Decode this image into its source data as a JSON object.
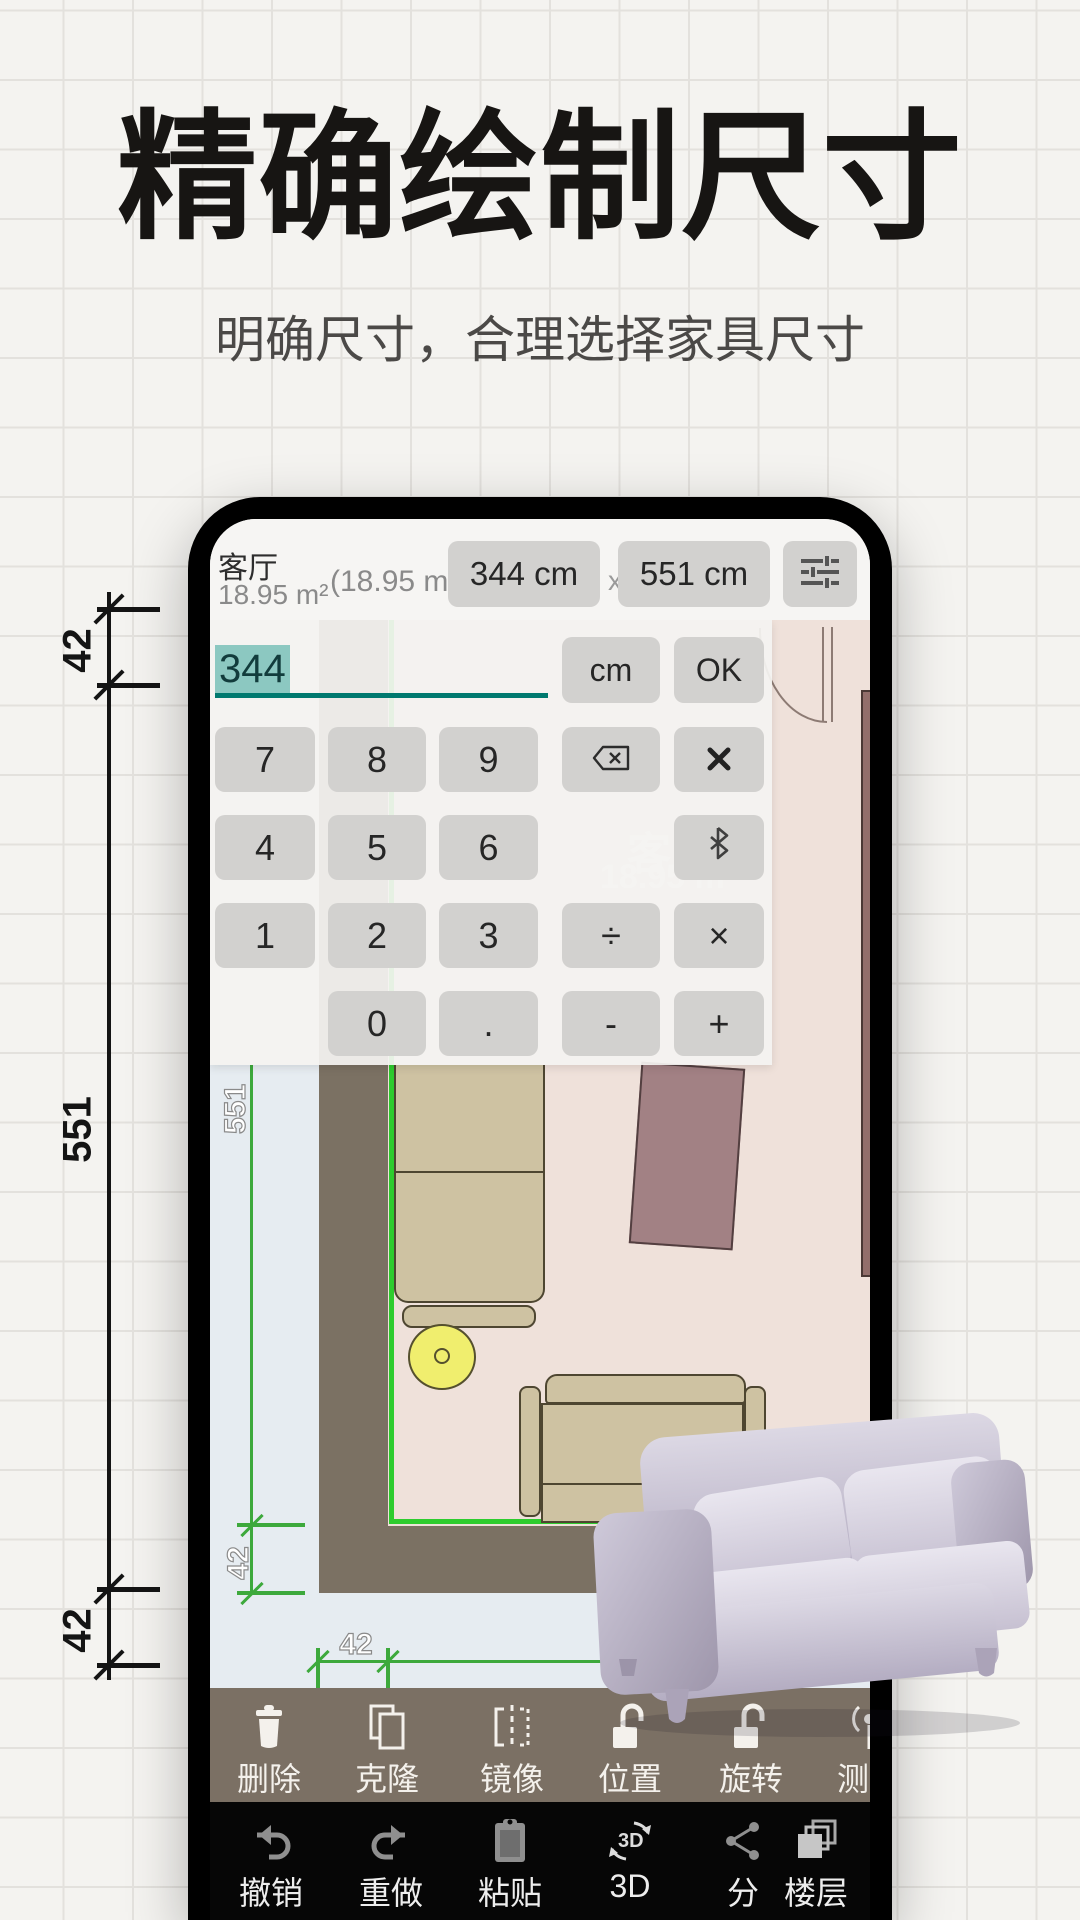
{
  "page": {
    "title": "精确绘制尺寸",
    "subtitle": "明确尺寸，合理选择家具尺寸"
  },
  "outer_dimensions": {
    "top": "42",
    "middle": "551",
    "bottom": "42"
  },
  "colors": {
    "accent_green": "#2ecc2e",
    "wall": "#7b7163",
    "floor": "#efe1da",
    "teal_underline": "#00796f",
    "toolbar_bg": "#7b7064",
    "navbar_bg": "#060606"
  },
  "phone": {
    "topbar": {
      "room_name": "客厅",
      "room_area": "18.95 m²",
      "room_area_secondary": "(18.95 m²)",
      "width_value": "344 cm",
      "separator": "x",
      "height_value": "551 cm"
    },
    "calculator": {
      "input_value": "344",
      "unit_button": "cm",
      "ok_button": "OK",
      "keys": {
        "k7": "7",
        "k8": "8",
        "k9": "9",
        "k4": "4",
        "k5": "5",
        "k6": "6",
        "k1": "1",
        "k2": "2",
        "k3": "3",
        "k0": "0",
        "dot": ".",
        "minus": "-",
        "plus": "+",
        "divide": "÷",
        "multiply": "×"
      }
    },
    "plan": {
      "room_label": "客厅",
      "room_label_area": "18.95 m²",
      "dim_551": "551",
      "dim_42_left": "42",
      "dim_42_bottom": "42"
    },
    "toolbar": [
      {
        "label": "删除"
      },
      {
        "label": "克隆"
      },
      {
        "label": "镜像"
      },
      {
        "label": "位置"
      },
      {
        "label": "旋转"
      },
      {
        "label": "测量"
      }
    ],
    "navbar": [
      {
        "label": "撤销"
      },
      {
        "label": "重做"
      },
      {
        "label": "粘贴"
      },
      {
        "label": "3D"
      },
      {
        "label": "分"
      },
      {
        "label": "楼层"
      }
    ]
  }
}
